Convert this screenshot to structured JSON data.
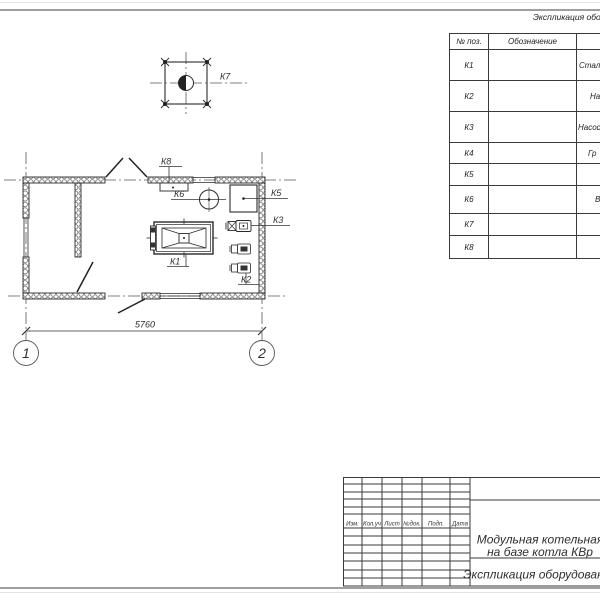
{
  "plan": {
    "dimension": "5760",
    "axis_left": "1",
    "axis_right": "2",
    "labels": {
      "k1": "К1",
      "k2": "К2",
      "k3": "К3",
      "k4": "К4",
      "k5": "К5",
      "k6": "К6",
      "k7": "К7",
      "k8": "К8"
    }
  },
  "equipment_table": {
    "title": "Экспликация оборудования",
    "columns": {
      "pos": "№ поз.",
      "designation": "Обозначение"
    },
    "rows": [
      {
        "pos": "К1",
        "name_fragment": "Стал"
      },
      {
        "pos": "К2",
        "name_fragment": "На"
      },
      {
        "pos": "К3",
        "name_fragment": "Насос"
      },
      {
        "pos": "К4",
        "name_fragment": "Гр"
      },
      {
        "pos": "К5",
        "name_fragment": ""
      },
      {
        "pos": "К6",
        "name_fragment": "В"
      },
      {
        "pos": "К7",
        "name_fragment": ""
      },
      {
        "pos": "К8",
        "name_fragment": ""
      }
    ]
  },
  "title_block": {
    "header_cells": [
      "Изм.",
      "Кол.уч",
      "Лист",
      "№док.",
      "Подп.",
      "Дата"
    ],
    "project_title_line1": "Модульная котельная",
    "project_title_line2": "на базе котла КВр",
    "sheet_title": "Экспликация оборудования"
  }
}
